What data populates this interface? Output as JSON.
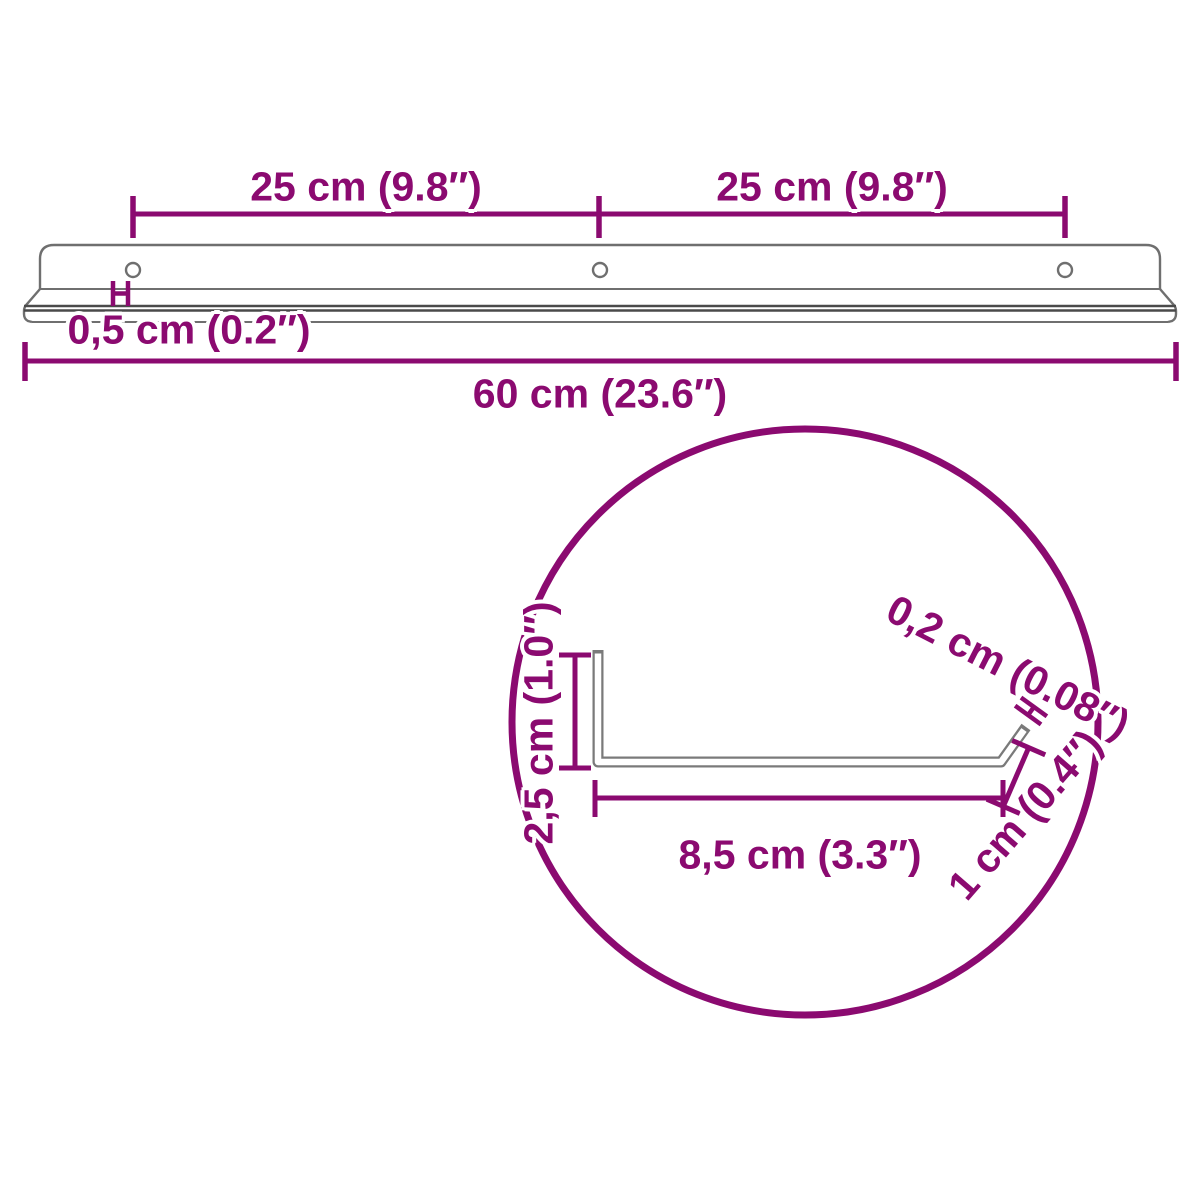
{
  "diagram_title": "Wall shelf dimension diagram",
  "colors": {
    "dimension_accent": "#8B0A70",
    "outline_gray": "#6F6F6F",
    "outline_dark": "#4A4A4A",
    "background": "#FFFFFF"
  },
  "front_view": {
    "hole_spacing_left_label": "25 cm (9.8″)",
    "hole_spacing_right_label": "25 cm (9.8″)",
    "rail_thickness_label": "0,5 cm (0.2″)",
    "overall_width_label": "60 cm (23.6″)",
    "mounting_hole_count": 3
  },
  "detail_view": {
    "profile_height_label": "2,5 cm (1.0″)",
    "material_thickness_label": "0,2 cm (0.08″)",
    "shelf_depth_label": "8,5 cm (3.3″)",
    "lip_height_label": "1 cm (0.4″)"
  }
}
